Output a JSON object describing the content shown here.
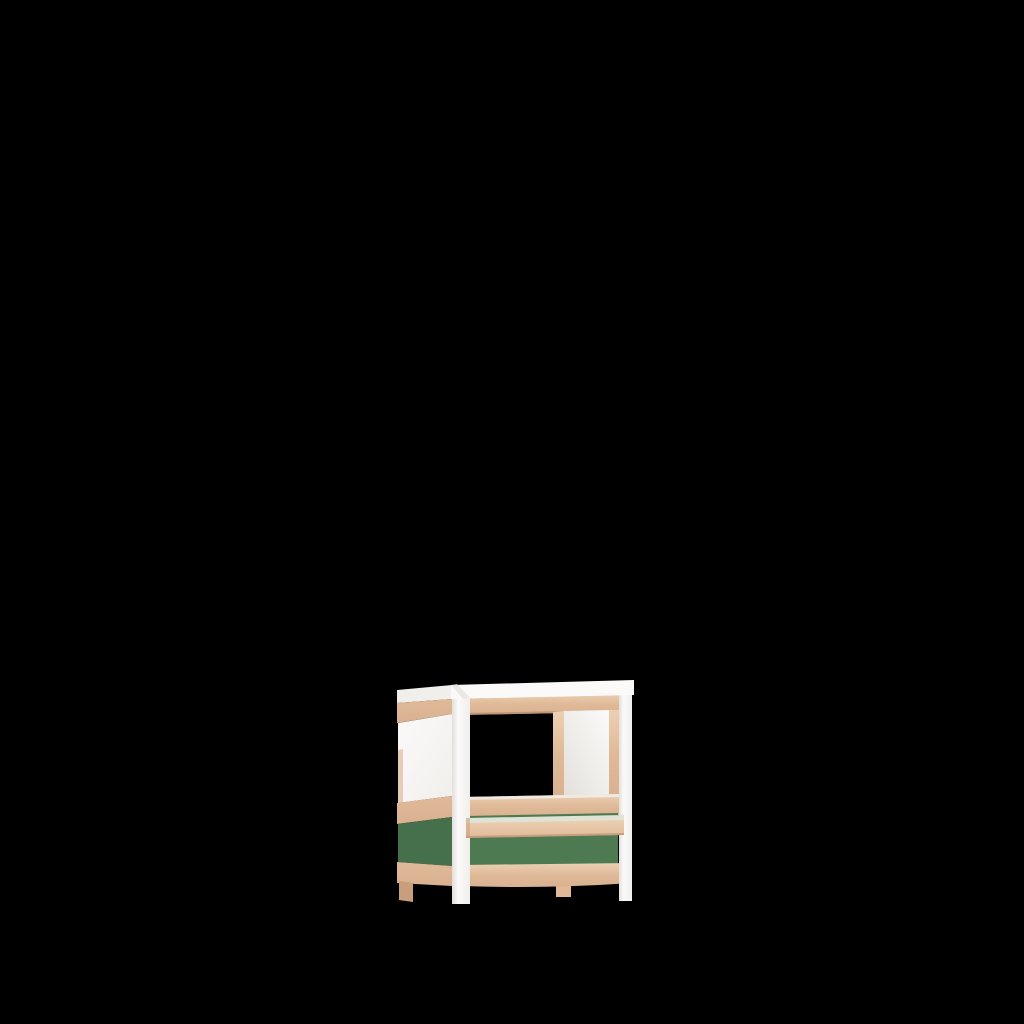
{
  "scene": {
    "background_color": "#000000",
    "object": "childrens-play-stand-frame",
    "description": "3D product render of a children's play stand / canopy frame with white corner posts, beech wood rails, an open serving window with counter bar, white infill panels and a green lower front panel, centered low on a solid black background",
    "render_position": "lower-center"
  },
  "colors": {
    "background": "#000000",
    "wood": "#e0ba98",
    "wood_light": "#ecd0b2",
    "wood_mid": "#d9b190",
    "wood_dark": "#c89e7d",
    "wood_edge": "#b28a6b",
    "white": "#fbfaf9",
    "white_dim": "#f1efec",
    "white_shadow": "#e3e0db",
    "green": "#4e7a52",
    "green_dark": "#46704b",
    "bar_highlight": "#dfe3d5"
  },
  "furniture": {
    "parts": [
      "top-cap",
      "side-top-rail",
      "side-white-panel",
      "side-mid-rail",
      "side-green-panel",
      "side-bottom-rail",
      "front-top-rail",
      "window-opening",
      "window-divider",
      "front-white-panel",
      "front-mid-rail",
      "counter-bar",
      "front-green-panel",
      "front-bottom-rail",
      "front-left-post",
      "front-right-post",
      "rear-left-leg",
      "rear-middle-leg"
    ]
  }
}
